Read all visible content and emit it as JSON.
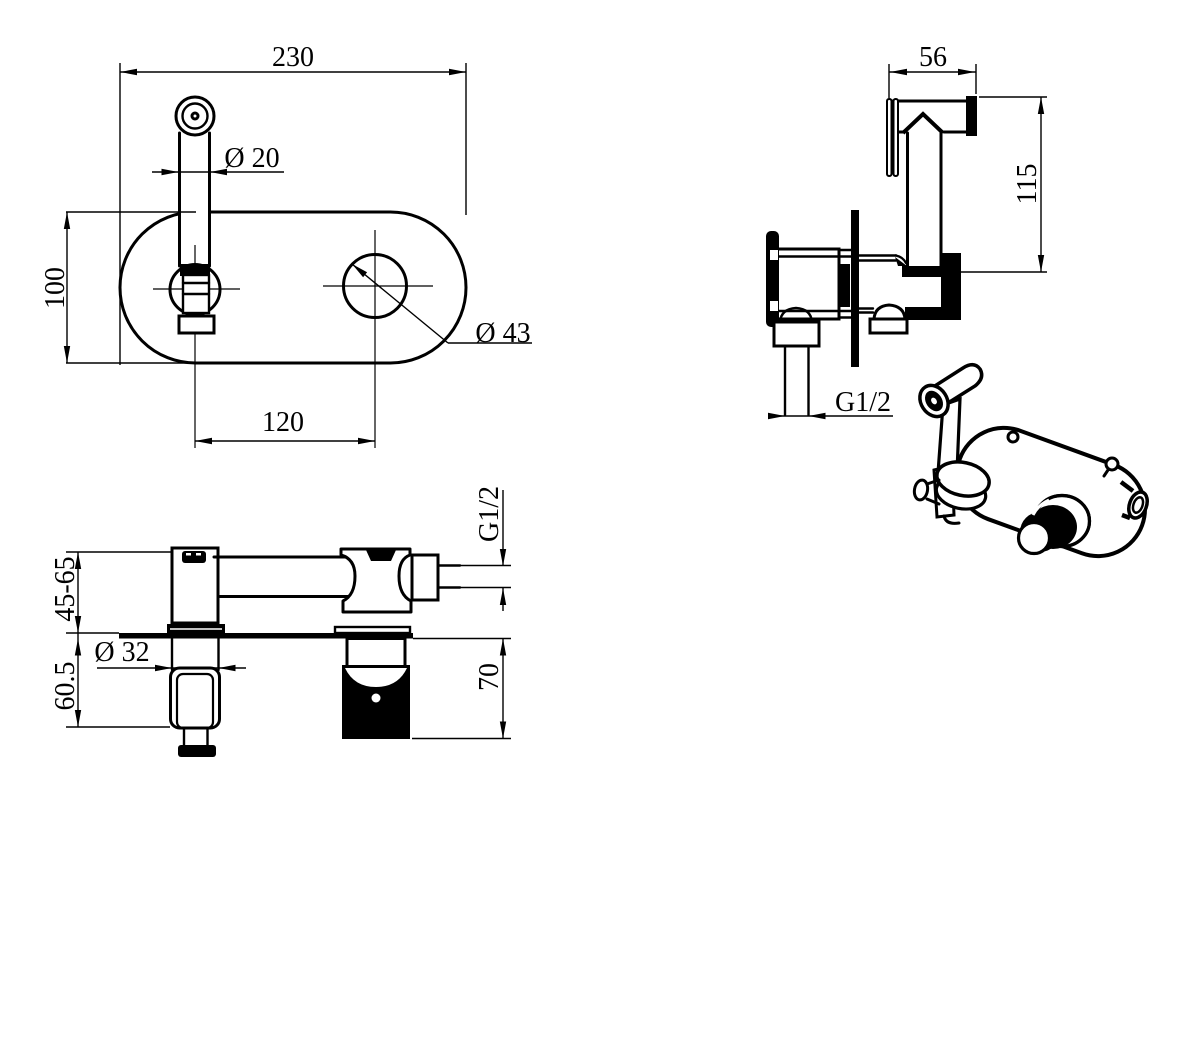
{
  "drawing_labels": {
    "front": {
      "overall_width": "230",
      "spout_diameter": "Ø 20",
      "overall_height": "100",
      "hole_diameter": "Ø 43",
      "center_distance": "120"
    },
    "side": {
      "head_length": "56",
      "overall_height": "115",
      "inlet_thread": "G1/2"
    },
    "bottom": {
      "wall_depth_range": "45-65",
      "recess_depth": "60.5",
      "hole_diameter": "Ø 32",
      "body_depth": "70",
      "outlet_thread": "G1/2"
    }
  }
}
